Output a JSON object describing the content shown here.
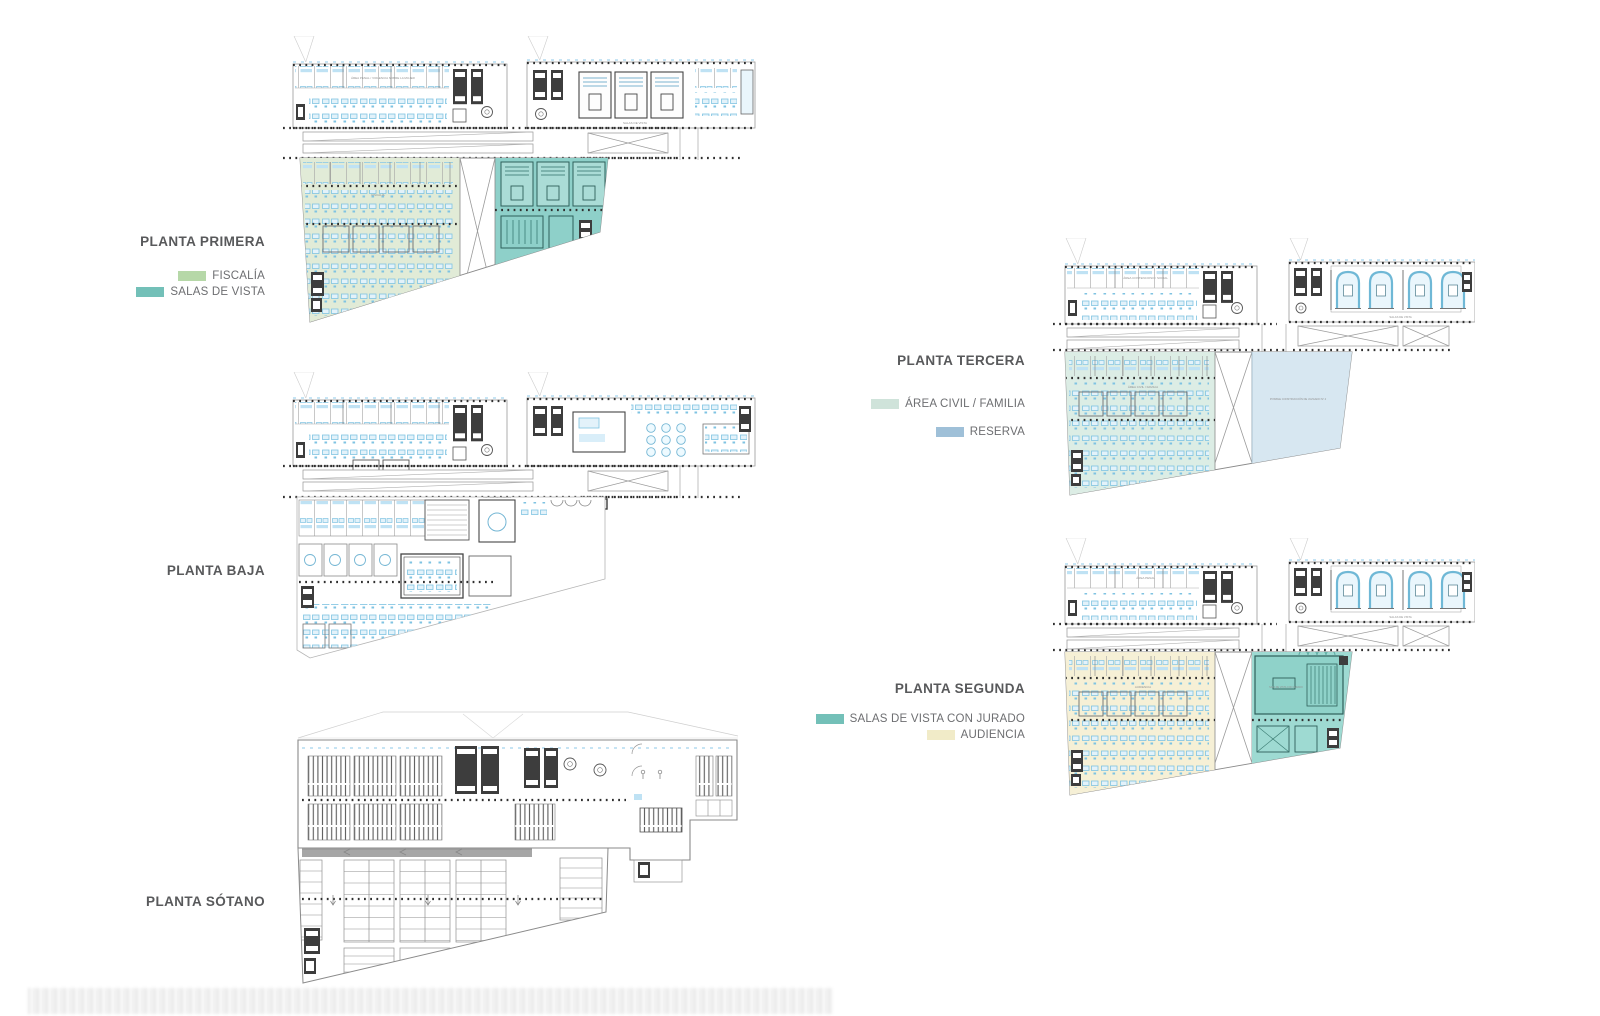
{
  "page": {
    "background": "#ffffff"
  },
  "plans": [
    {
      "id": "primera",
      "label": "PLANTA PRIMERA",
      "annotations": {
        "left_wing": "ÁREA PENAL / VIOLENCIA SOBRE LA MUJER",
        "right_wing": "SALAS DE VISTA",
        "zone_left": "FISCALÍA",
        "zone_right": "SALAS DE VISTA"
      },
      "legend": [
        {
          "label": "FISCALÍA",
          "color": "#b6d8a8"
        },
        {
          "label": "SALAS DE VISTA",
          "color": "#73c0b8"
        }
      ]
    },
    {
      "id": "baja",
      "label": "PLANTA BAJA",
      "annotations": {
        "control_room": "CONTROL DE ACCESOS"
      },
      "legend": []
    },
    {
      "id": "sotano",
      "label": "PLANTA SÓTANO",
      "annotations": {},
      "legend": []
    },
    {
      "id": "tercera",
      "label": "PLANTA TERCERA",
      "annotations": {
        "left_wing": "ÁREA CONTENCIOSO / SOCIAL",
        "right_wing": "SALAS DE VISTA",
        "zone_left": "ÁREA CIVIL / FAMILIA",
        "reserva": "POSIBLE CONSTRUCCIÓN DE JUZGADO Nº 4"
      },
      "legend": [
        {
          "label": "ÁREA CIVIL  / FAMILIA",
          "color": "#cfe3da"
        },
        {
          "label": "RESERVA",
          "color": "#9fc0d8"
        }
      ]
    },
    {
      "id": "segunda",
      "label": "PLANTA SEGUNDA",
      "annotations": {
        "left_wing": "ÁREA PENAL",
        "right_wing": "SALAS DE VISTA",
        "zone_left": "AUDIENCIA",
        "jury_room": "SALA DE VISTA CON JURADO"
      },
      "legend": [
        {
          "label": "SALAS DE VISTA CON JURADO",
          "color": "#73c0b8"
        },
        {
          "label": "AUDIENCIA",
          "color": "#f1ebc8"
        }
      ]
    }
  ],
  "colors": {
    "fiscalia_zone": "#e1ebd7",
    "salas_vista_zone": "#8ed0c9",
    "civil_zone": "#dcede5",
    "reserva_zone": "#d7e7f1",
    "audiencia_zone": "#f6f0d6",
    "jurado_zone": "#9edad2",
    "jurado_room": "#8fd2c9",
    "furniture": "#7fc3e2",
    "furniture_fill": "#e3f2fa",
    "wall_dark": "#3d3d3d",
    "line": "#9a9a9a",
    "dots": "#2f2f2f",
    "court_dark": "#2f5f5a",
    "arc_blue": "#6fb8d6",
    "basement_line": "#8a8a8a"
  }
}
